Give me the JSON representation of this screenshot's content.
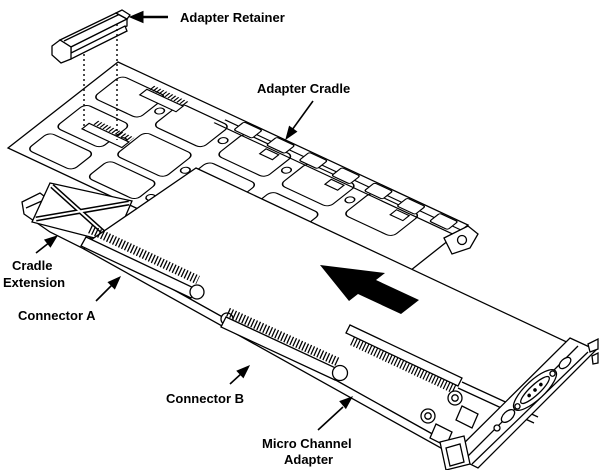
{
  "figure": {
    "background_color": "#ffffff",
    "line_color": "#000000",
    "arrow_fill": "#000000"
  },
  "labels": {
    "adapter_retainer": "Adapter Retainer",
    "adapter_cradle": "Adapter Cradle",
    "cradle_extension_line1": "Cradle",
    "cradle_extension_line2": "Extension",
    "connector_a": "Connector A",
    "connector_b": "Connector B",
    "micro_channel_adapter_line1": "Micro Channel",
    "micro_channel_adapter_line2": "Adapter"
  }
}
